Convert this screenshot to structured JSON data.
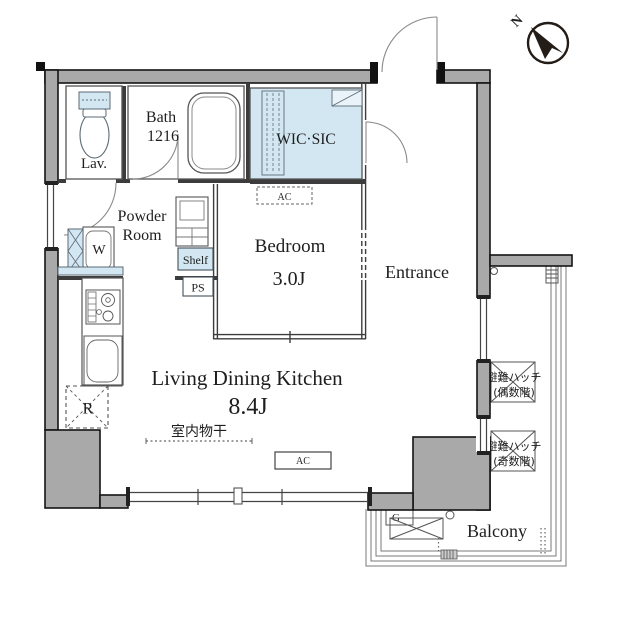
{
  "title": "Apartment floor plan",
  "colors": {
    "wall_fill": "#a9a9a9",
    "wall_edge": "#141414",
    "fixture_blue": "#d3e7f2",
    "line": "#555555",
    "text": "#1e1e1e",
    "background": "#ffffff"
  },
  "rooms": {
    "lav": {
      "label": "Lav."
    },
    "bath": {
      "label": "Bath",
      "size": "1216"
    },
    "powder_room": {
      "line1": "Powder",
      "line2": "Room"
    },
    "wic_sic": {
      "label": "WIC·SIC"
    },
    "bedroom": {
      "label": "Bedroom",
      "size": "3.0J"
    },
    "entrance": {
      "label": "Entrance"
    },
    "ldk": {
      "label": "Living Dining Kitchen",
      "size": "8.4J"
    },
    "balcony": {
      "label": "Balcony"
    }
  },
  "labels": {
    "washer": "W",
    "shelf": "Shelf",
    "pipe_space": "PS",
    "refrigerator": "R",
    "gas_meter": "G",
    "ac_bedroom": "AC",
    "ac_ldk": "AC",
    "indoor_drying": "室内物干",
    "hatch_even_line1": "避難ハッチ",
    "hatch_even_line2": "(偶数階)",
    "hatch_odd_line1": "避難ハッチ",
    "hatch_odd_line2": "(奇数階)",
    "north": "N"
  }
}
